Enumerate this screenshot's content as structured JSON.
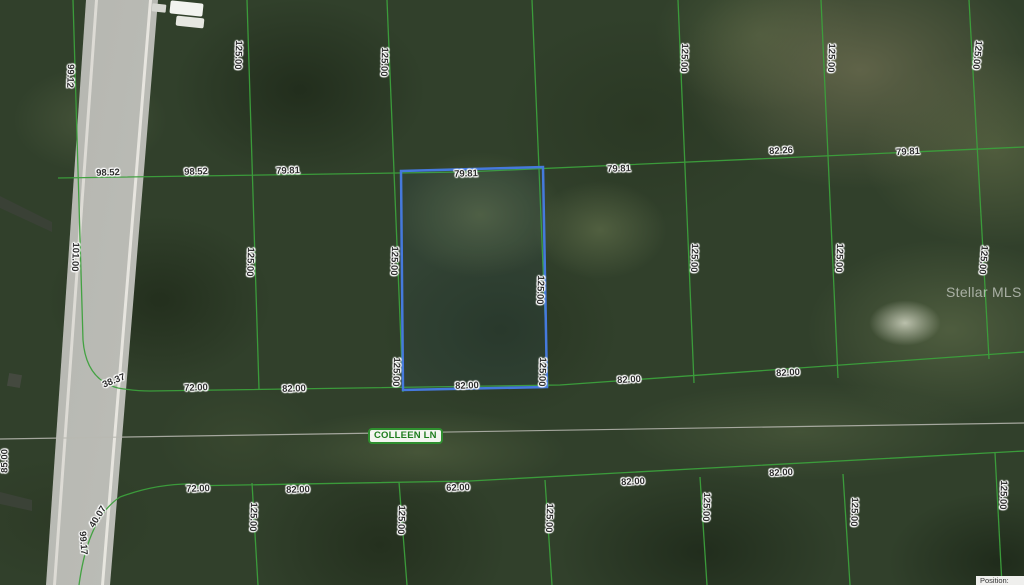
{
  "map": {
    "type": "aerial-parcel-map",
    "street_label": "COLLEEN LN",
    "watermark": "Stellar MLS",
    "position_label": "Position:",
    "line_color": "#3ca03c",
    "street_line_color": "#b9b9b2",
    "highlighted_parcel": {
      "border_color": "#4579dd",
      "top_dimension": "79.81",
      "bottom_dimension": "82.00",
      "left_dimension": "125.00",
      "right_dimension": "125.00"
    },
    "dimension_labels": [
      {
        "t": "99.12",
        "x": 70,
        "y": 76,
        "r": 92
      },
      {
        "t": "125.00",
        "x": 238,
        "y": 55,
        "r": 92
      },
      {
        "t": "125.00",
        "x": 384,
        "y": 62,
        "r": 92
      },
      {
        "t": "125.00",
        "x": 684,
        "y": 58,
        "r": 92
      },
      {
        "t": "125.00",
        "x": 831,
        "y": 58,
        "r": 92
      },
      {
        "t": "125.00",
        "x": 977,
        "y": 55,
        "r": 96
      },
      {
        "t": "98.52",
        "x": 108,
        "y": 173,
        "r": -2
      },
      {
        "t": "98.52",
        "x": 196,
        "y": 172,
        "r": -2
      },
      {
        "t": "79.81",
        "x": 288,
        "y": 171,
        "r": -2
      },
      {
        "t": "79.81",
        "x": 466,
        "y": 174,
        "r": -2
      },
      {
        "t": "79.81",
        "x": 619,
        "y": 169,
        "r": -2
      },
      {
        "t": "82.26",
        "x": 781,
        "y": 151,
        "r": -3
      },
      {
        "t": "79.81",
        "x": 908,
        "y": 152,
        "r": -3
      },
      {
        "t": "101.00",
        "x": 75,
        "y": 257,
        "r": 92
      },
      {
        "t": "125.00",
        "x": 250,
        "y": 262,
        "r": 92
      },
      {
        "t": "125.00",
        "x": 394,
        "y": 261,
        "r": 92
      },
      {
        "t": "125.00",
        "x": 540,
        "y": 290,
        "r": 92
      },
      {
        "t": "125.00",
        "x": 694,
        "y": 258,
        "r": 92
      },
      {
        "t": "125.00",
        "x": 839,
        "y": 258,
        "r": 92
      },
      {
        "t": "125.00",
        "x": 983,
        "y": 260,
        "r": 95
      },
      {
        "t": "125.00",
        "x": 396,
        "y": 372,
        "r": 92
      },
      {
        "t": "125.00",
        "x": 542,
        "y": 372,
        "r": 92
      },
      {
        "t": "38.37",
        "x": 114,
        "y": 381,
        "r": -22
      },
      {
        "t": "72.00",
        "x": 196,
        "y": 388,
        "r": -2
      },
      {
        "t": "82.00",
        "x": 294,
        "y": 389,
        "r": -2
      },
      {
        "t": "82.00",
        "x": 467,
        "y": 386,
        "r": -2
      },
      {
        "t": "82.00",
        "x": 629,
        "y": 380,
        "r": -3
      },
      {
        "t": "82.00",
        "x": 788,
        "y": 373,
        "r": -3
      },
      {
        "t": "72.00",
        "x": 198,
        "y": 489,
        "r": -2
      },
      {
        "t": "82.00",
        "x": 298,
        "y": 490,
        "r": -2
      },
      {
        "t": "62.00",
        "x": 458,
        "y": 488,
        "r": -2
      },
      {
        "t": "82.00",
        "x": 633,
        "y": 482,
        "r": -3
      },
      {
        "t": "82.00",
        "x": 781,
        "y": 473,
        "r": -3
      },
      {
        "t": "99.17",
        "x": 83,
        "y": 543,
        "r": 86
      },
      {
        "t": "40.07",
        "x": 98,
        "y": 517,
        "r": -58
      },
      {
        "t": "85.00",
        "x": 5,
        "y": 461,
        "r": -90
      },
      {
        "t": "125.00",
        "x": 253,
        "y": 517,
        "r": 92
      },
      {
        "t": "125.00",
        "x": 401,
        "y": 520,
        "r": 92
      },
      {
        "t": "125.00",
        "x": 549,
        "y": 518,
        "r": 92
      },
      {
        "t": "125.00",
        "x": 706,
        "y": 507,
        "r": 92
      },
      {
        "t": "125.00",
        "x": 854,
        "y": 512,
        "r": 92
      },
      {
        "t": "125.00",
        "x": 1003,
        "y": 495,
        "r": 92
      }
    ]
  }
}
